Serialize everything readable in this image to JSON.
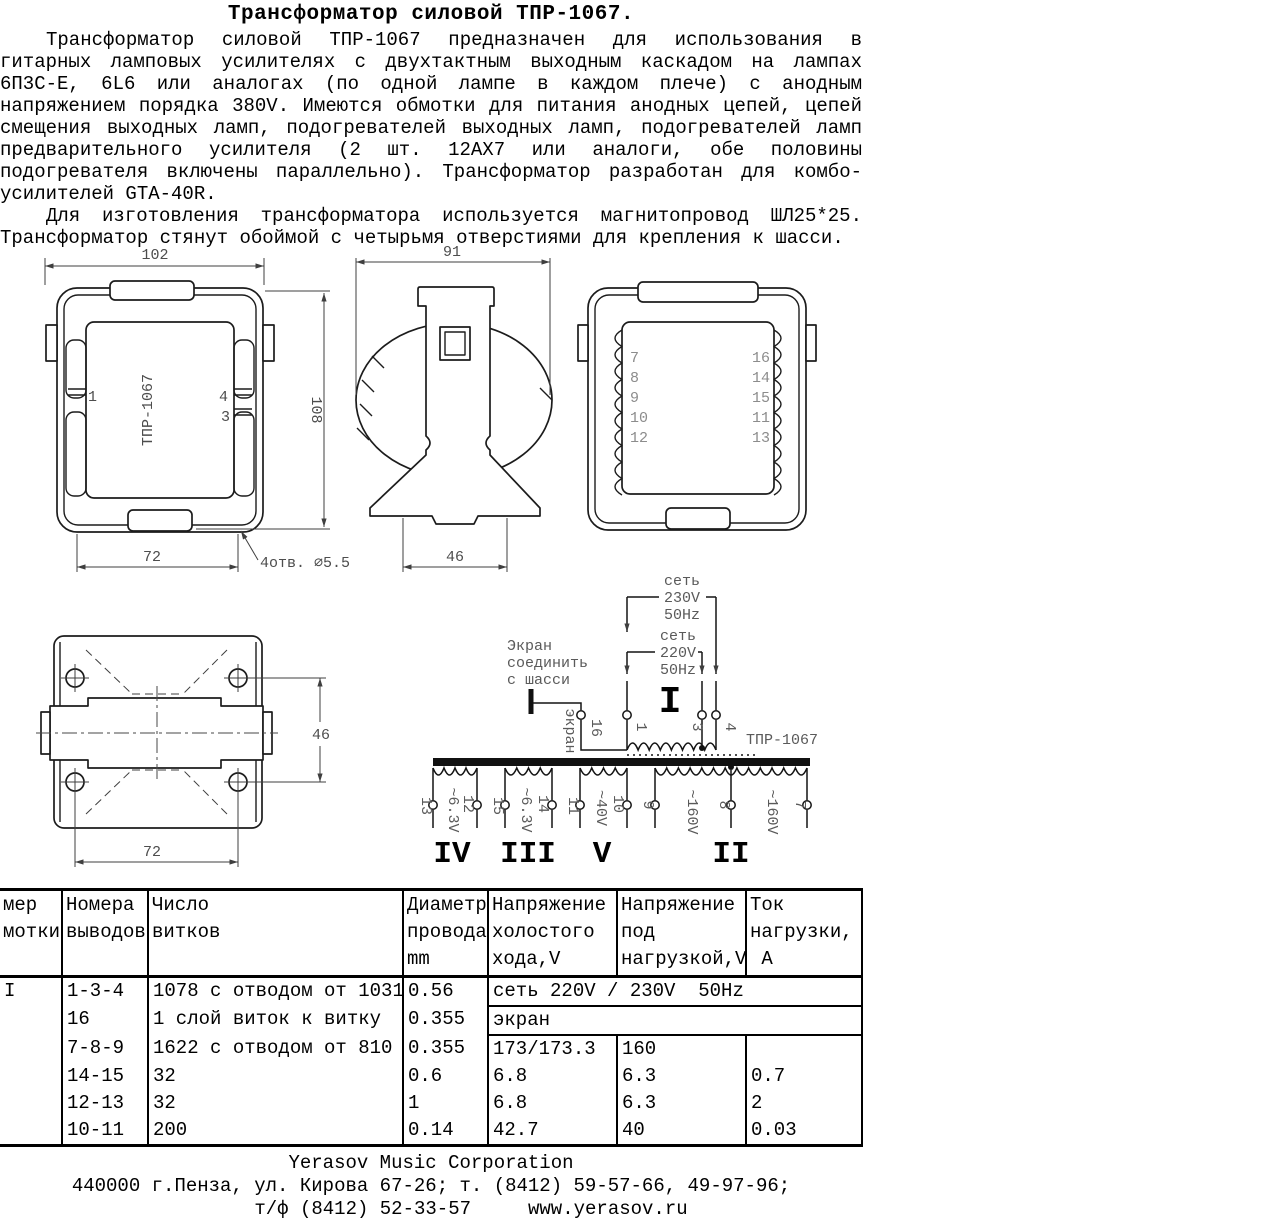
{
  "title": "Трансформатор силовой ТПР-1067.",
  "intro": {
    "p1_lines": [
      "Трансформатор силовой ТПР-1067 предназначен для использования в",
      "гитарных ламповых усилителях с двухтактным выходным каскадом на лампах",
      "6П3С-Е, 6L6 или аналогах (по одной лампе в каждом плече) с анодным",
      "напряжением порядка 380V. Имеются обмотки для питания анодных цепей, цепей",
      "смещения выходных ламп, подогревателей выходных ламп, подогревателей ламп",
      "предварительного усилителя (2 шт. 12AX7 или аналоги, обе половины",
      "подогревателя включены параллельно). Трансформатор разработан для комбо-",
      "усилителей GTA-40R."
    ],
    "p2_lines": [
      "Для изготовления трансформатора используется магнитопровод ШЛ25*25.",
      "Трансформатор стянут обоймой с четырьмя отверстиями для крепления к шасси."
    ]
  },
  "drawings": {
    "front": {
      "dim_top": "102",
      "dim_right": "108",
      "dim_bottom": "72",
      "holes_note": "4отв. ∅5.5",
      "label": "ТПР-1067",
      "pin_left": "1",
      "pin_right_top": "4",
      "pin_right_bottom": "3"
    },
    "side": {
      "dim_top": "91",
      "dim_bottom": "46"
    },
    "rear": {
      "pins_left": [
        "7",
        "8",
        "9",
        "10",
        "12"
      ],
      "pins_right": [
        "16",
        "14",
        "15",
        "11",
        "13"
      ]
    },
    "top": {
      "dim_right": "46",
      "dim_bottom": "72"
    }
  },
  "schematic": {
    "mains230": [
      "сеть",
      "230V",
      "50Hz"
    ],
    "mains220": [
      "сеть",
      "220V",
      "50Hz"
    ],
    "screen_note": [
      "Экран",
      "соединить",
      "с шасси"
    ],
    "screen_wire_label": "экран",
    "model": "ТПР-1067",
    "primary": {
      "numeral": "I",
      "pin1": "1",
      "pin3": "3",
      "pin4": "4",
      "pin16": "16"
    },
    "secondaries": [
      {
        "numeral": "IV",
        "pin_l": "13",
        "pin_r": "12",
        "voltage": "~6.3V"
      },
      {
        "numeral": "III",
        "pin_l": "15",
        "pin_r": "14",
        "voltage": "~6.3V"
      },
      {
        "numeral": "V",
        "pin_l": "11",
        "pin_r": "10",
        "voltage": "~40V"
      },
      {
        "numeral": "II",
        "pin_l": "9",
        "pin_m": "8",
        "pin_r": "7",
        "voltage_l": "~160V",
        "voltage_r": "~160V"
      }
    ]
  },
  "table": {
    "headers": {
      "col1": "мер\nмотки",
      "col2": "Номера\nвыводов",
      "col3": "Число\nвитков",
      "col4": "Диаметр\nпровода\nmm",
      "col5": "Напряжение\nхолостого\nхода,V",
      "col6": "Напряжение\nпод\nнагрузкой,V",
      "col7": "Ток\nнагрузки,\n А"
    },
    "winding": "I",
    "rows": [
      {
        "pins": "1-3-4",
        "turns": "1078 с отводом от 1031",
        "dia": "0.56",
        "span": "сеть 220V / 230V  50Hz"
      },
      {
        "pins": "16",
        "turns": "1 слой виток к витку",
        "dia": "0.355",
        "span": "экран"
      },
      {
        "pins": "7-8-9",
        "turns": "1622 с отводом от 810",
        "dia": "0.355",
        "noload": "173/173.3",
        "load": "160",
        "current": ""
      },
      {
        "pins": "14-15",
        "turns": "32",
        "dia": "0.6",
        "noload": "6.8",
        "load": "6.3",
        "current": "0.7"
      },
      {
        "pins": "12-13",
        "turns": "32",
        "dia": "1",
        "noload": "6.8",
        "load": "6.3",
        "current": "2"
      },
      {
        "pins": "10-11",
        "turns": "200",
        "dia": "0.14",
        "noload": "42.7",
        "load": "40",
        "current": "0.03"
      }
    ]
  },
  "footer": {
    "line1": "Yerasov Music Corporation",
    "line2": "440000 г.Пенза, ул. Кирова 67-26; т. (8412) 59-57-66, 49-97-96;",
    "line3": "т/ф (8412) 52-33-57     www.yerasov.ru"
  }
}
